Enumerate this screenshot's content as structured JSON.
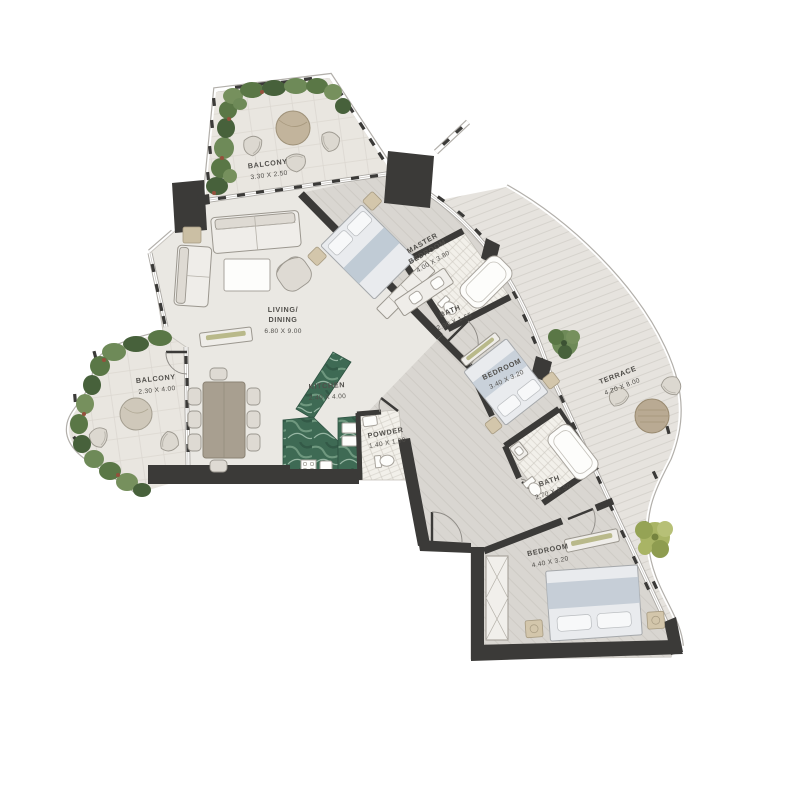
{
  "plan": {
    "type": "apartment-floor-plan",
    "rooms": {
      "balcony_top": {
        "name": "BALCONY",
        "dims": "3.30 X 2.50"
      },
      "living_dining": {
        "name_line1": "LIVING/",
        "name_line2": "DINING",
        "dims": "6.80 X 9.00"
      },
      "kitchen": {
        "name": "KITCHEN",
        "dims": "2.40 X 4.00"
      },
      "balcony_left": {
        "name": "BALCONY",
        "dims": "2.30 X 4.00"
      },
      "powder": {
        "name": "POWDER",
        "dims": "1.40 X 1.90"
      },
      "master_bedroom": {
        "name_line1": "MASTER",
        "name_line2": "BEDROOM",
        "dims": "4.00 X 3.80"
      },
      "master_bath": {
        "name": "BATH",
        "dims": "2.90 X 1.65"
      },
      "bedroom_2": {
        "name": "BEDROOM",
        "dims": "3.40 X 3.20"
      },
      "terrace": {
        "name": "TERRACE",
        "dims": "4.20 X 8.00"
      },
      "bath_2": {
        "name": "BATH",
        "dims": "2.70 X 2.50"
      },
      "bedroom_3": {
        "name": "BEDROOM",
        "dims": "4.40 X 3.20"
      }
    },
    "colors": {
      "wall": "#3b3a38",
      "floor": "#eae8e3",
      "wing_floor": "#d9d6d1",
      "balcony_floor": "#e9e6e0",
      "greenery_dark": "#47613b",
      "greenery_mid": "#5a7746",
      "greenery_light": "#76905d",
      "tree_yellow_green": "#a9b465",
      "kitchen_marble": "#3e6a54",
      "bath_tile": "#f2f0ea",
      "label_text": "#504e4a"
    }
  }
}
